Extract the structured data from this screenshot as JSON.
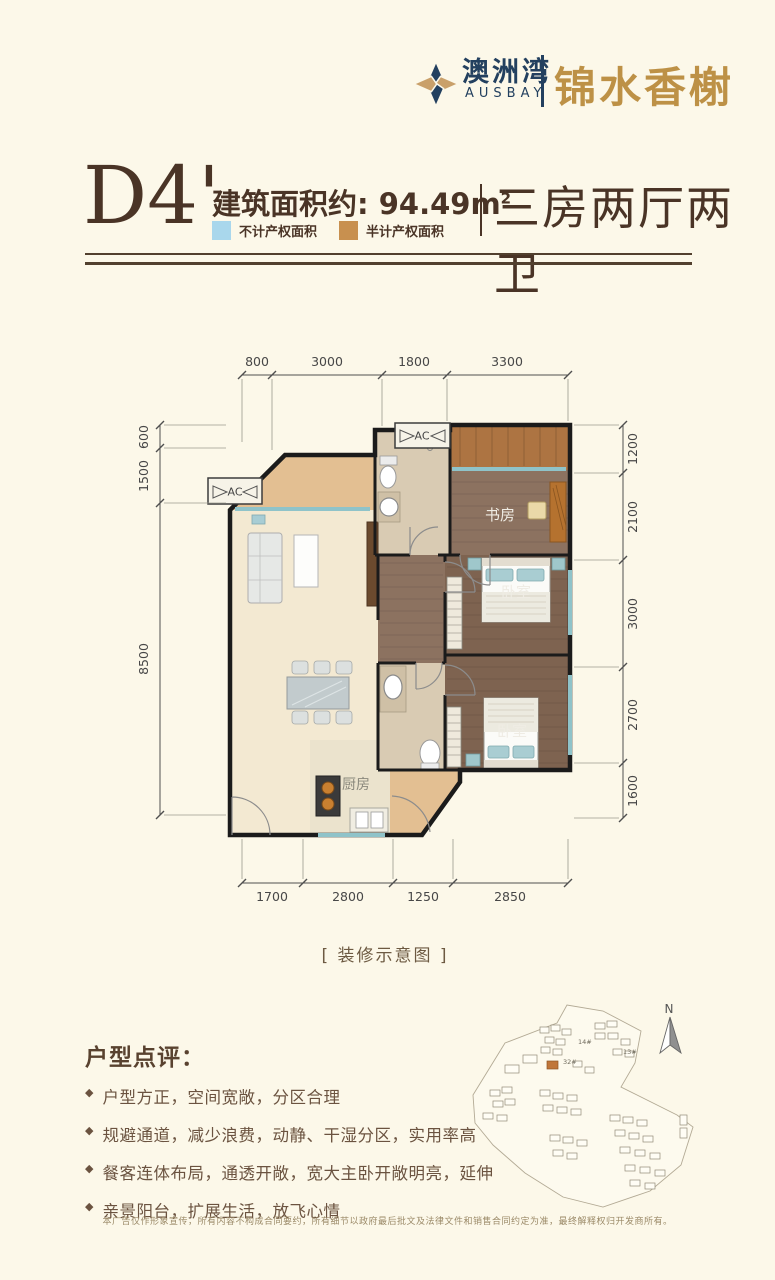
{
  "page": {
    "background_color": "#fcf8e9"
  },
  "logo": {
    "brand_cn": "澳洲湾",
    "brand_en": "AUSBAY",
    "project_name": "锦水香榭",
    "navy_color": "#23405f",
    "gold_color": "#bd9146"
  },
  "header_title": {
    "unit_code": "D4'",
    "area_label": "建筑面积约:",
    "area_value": "94.49m",
    "area_superscript": "2",
    "layout_text": "三房两厅两卫"
  },
  "legend": {
    "items": [
      {
        "label": "不计产权面积",
        "color": "#a9d7ec"
      },
      {
        "label": "半计产权面积",
        "color": "#c8904f"
      }
    ]
  },
  "floorplan": {
    "ac_label": "AC",
    "rooms": {
      "study": "书房",
      "bedroom1": "卧室",
      "bedroom2": "卧室",
      "kitchen": "厨房"
    },
    "dims_top": [
      "800",
      "3000",
      "1800",
      "3300"
    ],
    "dims_left": [
      "600",
      "1500",
      "8500"
    ],
    "dims_right": [
      "1200",
      "2100",
      "3000",
      "2700",
      "1600"
    ],
    "dims_bottom": [
      "1700",
      "2800",
      "1250",
      "2850"
    ],
    "caption": "[ 装修示意图 ]"
  },
  "siteplan": {
    "north_label": "N",
    "building_labels": {
      "b32": "32#",
      "b14": "14#",
      "b13": "13#"
    },
    "highlight_color": "#c0763a"
  },
  "review": {
    "title": "户型点评：",
    "bullet_icon": "◆",
    "bullets": [
      "户型方正，空间宽敞，分区合理",
      "规避通道，减少浪费，动静、干湿分区，实用率高",
      "餐客连体布局，通透开敞，宽大主卧开敞明亮，延伸",
      "亲景阳台，扩展生活，放飞心情"
    ]
  },
  "disclaimer": "本广告仅作形象宣传，所有内容不构成合同要约，所有细节以政府最后批文及法律文件和销售合同约定为准，最终解释权归开发商所有。"
}
